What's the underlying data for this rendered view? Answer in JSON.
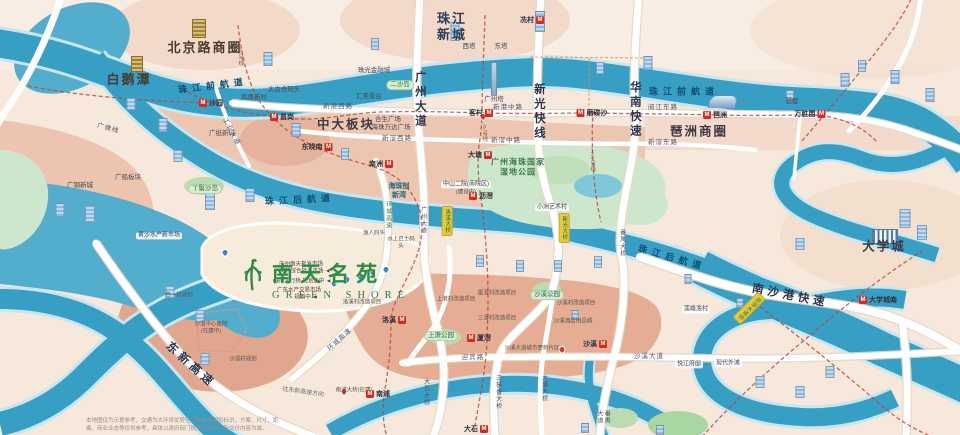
{
  "logo": {
    "cn": "南天名苑",
    "en": "GREEN SHORE"
  },
  "disclaimer": {
    "line1": "本地图仅为示意参考，交通为大环境优势空间距离用图形标识，方案、尺寸、距",
    "line2": "离、商业业态等仅供参考，具体以政府部门批准文件及实际交付内容为准。"
  },
  "colors": {
    "river": "#379fc4",
    "land": "#f6e9db",
    "urban": "#eabda6",
    "salmon": "#e0a287",
    "park": "#cde7cc",
    "road": "#ffffff",
    "metro_line": "#bf4136",
    "metro_icon": "#d42b1e",
    "bridge_tag": "#e9c93c",
    "logo_green": "#2f8a46"
  },
  "labels": [
    {
      "t": "北京路商圈",
      "x": 205,
      "y": 48,
      "c": "a1",
      "n": "area-beijinglu"
    },
    {
      "t": "白鹅潭",
      "x": 129,
      "y": 80,
      "c": "a1",
      "n": "area-baietan"
    },
    {
      "t": "珠江新城",
      "x": 452,
      "y": 27,
      "c": "a2w",
      "w": 34,
      "n": "area-zhujiang-new-town"
    },
    {
      "t": "中大板块",
      "x": 346,
      "y": 125,
      "c": "a2",
      "n": "area-zhongda"
    },
    {
      "t": "琶洲商圈",
      "x": 699,
      "y": 132,
      "c": "a2",
      "n": "area-pazhou"
    },
    {
      "t": "大学城",
      "x": 884,
      "y": 247,
      "c": "a2",
      "n": "area-university-town"
    },
    {
      "t": "广钢新城",
      "x": 80,
      "y": 186,
      "c": "poi",
      "n": "area-guanggang"
    },
    {
      "t": "广船板块",
      "x": 128,
      "y": 178,
      "c": "poi",
      "n": "area-guangchuan"
    },
    {
      "t": "广纸新城",
      "x": 222,
      "y": 134,
      "c": "poi",
      "n": "area-guangzhi"
    },
    {
      "t": "海珠创新湾",
      "x": 399,
      "y": 191,
      "c": "teal",
      "w": 24,
      "n": "area-haizhu-bay"
    },
    {
      "t": "广州海珠国家湿地公园",
      "x": 518,
      "y": 168,
      "c": "green2",
      "w": 60,
      "n": "area-wetland-park"
    },
    {
      "t": "珠江前航道",
      "x": 213,
      "y": 86,
      "c": "rv",
      "r": -7,
      "n": "river-front-channel-west"
    },
    {
      "t": "珠江前航道",
      "x": 684,
      "y": 92,
      "c": "rv",
      "n": "river-front-channel-east"
    },
    {
      "t": "珠江后航道",
      "x": 300,
      "y": 200,
      "c": "rv",
      "r": -3,
      "n": "river-back-channel-west"
    },
    {
      "t": "珠江后航道",
      "x": 672,
      "y": 258,
      "c": "rv",
      "r": 16,
      "n": "river-back-channel-east"
    },
    {
      "t": "广州大道",
      "x": 419,
      "y": 100,
      "c": "rdv",
      "n": "road-guangzhou-avenue"
    },
    {
      "t": "新光快线",
      "x": 538,
      "y": 112,
      "c": "rdv",
      "n": "road-xinguang-express"
    },
    {
      "t": "华南快速",
      "x": 634,
      "y": 110,
      "c": "rdv",
      "n": "road-huanan-expressway"
    },
    {
      "t": "东新高速",
      "x": 190,
      "y": 366,
      "c": "rdr",
      "r": 42,
      "n": "road-dongxin-expressway"
    },
    {
      "t": "南沙港快速",
      "x": 790,
      "y": 297,
      "c": "rdr",
      "r": 11,
      "n": "road-nansha-port-expressway"
    },
    {
      "t": "新港西路",
      "x": 338,
      "y": 107,
      "c": "rdh",
      "n": "road-xingang-west"
    },
    {
      "t": "新港中路",
      "x": 508,
      "y": 108,
      "c": "rdh",
      "n": "road-xingang-middle"
    },
    {
      "t": "阅江东路",
      "x": 663,
      "y": 108,
      "c": "rdh",
      "n": "road-yuejiang-east"
    },
    {
      "t": "新滘西路",
      "x": 397,
      "y": 139,
      "c": "rdh",
      "n": "road-xinjiao-west"
    },
    {
      "t": "新滘中路",
      "x": 506,
      "y": 141,
      "c": "rdh",
      "n": "road-xinjiao-middle"
    },
    {
      "t": "新滘东路",
      "x": 663,
      "y": 143,
      "c": "rdh",
      "n": "road-xinjiao-east"
    },
    {
      "t": "迎宾路",
      "x": 473,
      "y": 358,
      "c": "rdh",
      "n": "road-yingbin"
    },
    {
      "t": "沙溪大道",
      "x": 649,
      "y": 357,
      "c": "rdh",
      "n": "road-shaxi-avenue"
    },
    {
      "t": "工业大道",
      "x": 231,
      "y": 132,
      "c": "rdh",
      "r": 62,
      "n": "road-gongye-avenue"
    },
    {
      "t": "广佛线",
      "x": 108,
      "y": 129,
      "c": "rdh",
      "r": 15,
      "n": "metro-guangfo-line"
    },
    {
      "t": "环城高速",
      "x": 340,
      "y": 340,
      "c": "rdh",
      "r": -42,
      "n": "road-ring-expressway-south"
    },
    {
      "t": "环城高速",
      "x": 387,
      "y": 215,
      "c": "rdgv",
      "n": "road-ring-expressway"
    },
    {
      "t": "广州大道",
      "x": 422,
      "y": 220,
      "c": "rdsv",
      "n": "road-guangzhou-avenue-bridge"
    },
    {
      "t": "番禺大道",
      "x": 602,
      "y": 417,
      "c": "rdsv",
      "n": "road-panyu-avenue"
    },
    {
      "t": "大石大桥",
      "x": 425,
      "y": 392,
      "c": "rdsv",
      "n": "bridge-dashi"
    },
    {
      "t": "三枝香大桥",
      "x": 497,
      "y": 392,
      "c": "rdsv",
      "n": "bridge-sanzhixiang"
    },
    {
      "t": "大涌大桥",
      "x": 543,
      "y": 388,
      "c": "rdsv",
      "n": "bridge-dachong"
    },
    {
      "t": "番禺大桥",
      "x": 621,
      "y": 243,
      "c": "rdsv",
      "n": "bridge-panyu"
    },
    {
      "t": "往东新高速方向",
      "x": 303,
      "y": 393,
      "c": "rdh6",
      "r": 8,
      "n": "road-direction-dongxin"
    },
    {
      "t": "洛溪大桥",
      "x": 447,
      "y": 221,
      "c": "yb",
      "n": "bridge-luoxi-tag"
    },
    {
      "t": "新光大桥",
      "x": 564,
      "y": 228,
      "c": "yb",
      "n": "bridge-xinguang-tag"
    },
    {
      "t": "沥滘水道桥",
      "x": 749,
      "y": 308,
      "c": "yb",
      "r": 45,
      "n": "bridge-lijiao-tag"
    },
    {
      "t": "2号线",
      "x": 240,
      "y": 57,
      "c": "ln",
      "n": "metro-line-2-label"
    },
    {
      "t": "3号线",
      "x": 484,
      "y": 133,
      "c": "ln",
      "n": "metro-line-3-label"
    },
    {
      "t": "12号线",
      "x": 592,
      "y": 160,
      "c": "ln",
      "n": "metro-line-12-label"
    },
    {
      "t": "珠光金融城",
      "x": 374,
      "y": 71,
      "c": "poi",
      "n": "poi-zhuguang-finance"
    },
    {
      "t": "汇美景台",
      "x": 369,
      "y": 97,
      "c": "poi",
      "n": "poi-huimei"
    },
    {
      "t": "太古仓码头",
      "x": 284,
      "y": 90,
      "c": "poi",
      "n": "poi-taikoo-wharf"
    },
    {
      "t": "凤凰新村",
      "x": 254,
      "y": 98,
      "c": "poi",
      "n": "poi-fenghuang"
    },
    {
      "t": "合生广场",
      "x": 388,
      "y": 120,
      "c": "poi",
      "n": "poi-hesheng-plaza"
    },
    {
      "t": "海珠万达广场",
      "x": 391,
      "y": 128,
      "c": "poi",
      "n": "poi-wanda-plaza"
    },
    {
      "t": "中山二院(南院区)",
      "x": 466,
      "y": 185,
      "c": "poiw",
      "n": "poi-hospital-zhongshan"
    },
    {
      "t": "(建设中)",
      "x": 466,
      "y": 193,
      "c": "poi6",
      "n": "poi-hospital-status"
    },
    {
      "t": "西塔",
      "x": 469,
      "y": 47,
      "c": "poi",
      "n": "poi-west-tower"
    },
    {
      "t": "东塔",
      "x": 501,
      "y": 47,
      "c": "poi",
      "n": "poi-east-tower"
    },
    {
      "t": "广州塔",
      "x": 494,
      "y": 100,
      "c": "poi",
      "n": "poi-canton-tower"
    },
    {
      "t": "琶醍",
      "x": 792,
      "y": 102,
      "c": "poi",
      "n": "poi-party-pier"
    },
    {
      "t": "二沙岛",
      "x": 400,
      "y": 85,
      "c": "gp",
      "n": "poi-ersha-island"
    },
    {
      "t": "丫髻沙岛",
      "x": 205,
      "y": 189,
      "c": "gp",
      "n": "poi-yajisha-island"
    },
    {
      "t": "上漖公园",
      "x": 441,
      "y": 336,
      "c": "gp",
      "n": "poi-shangjiao-park"
    },
    {
      "t": "沙溪公园",
      "x": 547,
      "y": 295,
      "c": "gp",
      "n": "poi-shaxi-park"
    },
    {
      "t": "黄沙水产新市场",
      "x": 159,
      "y": 236,
      "c": "poiw",
      "w": 42,
      "n": "poi-huangsha-market"
    },
    {
      "t": "渔人码头",
      "x": 374,
      "y": 234,
      "c": "poi6",
      "n": "poi-fisherman-wharf"
    },
    {
      "t": "水上巴士码头",
      "x": 401,
      "y": 243,
      "c": "poi6",
      "w": 28,
      "n": "poi-water-bus-wharf"
    },
    {
      "t": "洛溪村改造项目",
      "x": 362,
      "y": 303,
      "c": "poi6",
      "n": "poi-luoxi-renewal"
    },
    {
      "t": "上漖村改造项目",
      "x": 456,
      "y": 300,
      "c": "poi6",
      "n": "poi-shangjiao-renewal"
    },
    {
      "t": "厦滘村改造项目",
      "x": 497,
      "y": 294,
      "c": "poi6",
      "n": "poi-xiajiao-renewal"
    },
    {
      "t": "三滘村改造项目",
      "x": 497,
      "y": 319,
      "c": "poi6",
      "n": "poi-sanjiao-renewal"
    },
    {
      "t": "沙溪村改造项目",
      "x": 576,
      "y": 304,
      "c": "poi6",
      "n": "poi-shaxi-renewal"
    },
    {
      "t": "沙溪酒店用品城",
      "x": 573,
      "y": 322,
      "c": "poi6",
      "n": "poi-shaxi-hotel-city"
    },
    {
      "t": "沙溪大道城市更新片区",
      "x": 532,
      "y": 349,
      "c": "poi6",
      "n": "poi-shaxi-renewal-zone"
    },
    {
      "t": "小洲艺术村",
      "x": 552,
      "y": 208,
      "c": "poiw",
      "n": "poi-xiaozhou-village"
    },
    {
      "t": "莲峰渔村",
      "x": 696,
      "y": 310,
      "c": "poiw",
      "n": "poi-lianfeng-village"
    },
    {
      "t": "悦江府邸",
      "x": 689,
      "y": 365,
      "c": "poiw",
      "n": "poi-yuejiang-estate"
    },
    {
      "t": "现代外滩",
      "x": 728,
      "y": 364,
      "c": "poiw",
      "n": "poi-modern-bund"
    },
    {
      "t": "西一村规划",
      "x": 179,
      "y": 296,
      "c": "poi6",
      "n": "poi-xiyi-plan"
    },
    {
      "t": "沙滘村规划",
      "x": 243,
      "y": 360,
      "c": "poi6",
      "n": "poi-shajiao-plan"
    },
    {
      "t": "沙滘中心医院",
      "x": 211,
      "y": 325,
      "c": "poi6",
      "n": "poi-shajiao-hospital"
    },
    {
      "t": "(在建中)",
      "x": 211,
      "y": 332,
      "c": "poi6",
      "n": "poi-shajiao-hospital-status"
    },
    {
      "t": "南浦大桥(在建)",
      "x": 354,
      "y": 391,
      "c": "poi6",
      "n": "poi-nanpu-bridge"
    },
    {
      "t": "广州南天批发市场",
      "x": 301,
      "y": 265,
      "c": "co",
      "n": "callout-nantian-market"
    },
    {
      "t": "海鲜综合批发市场 ◄",
      "x": 305,
      "y": 272,
      "c": "co",
      "n": "callout-seafood-market"
    },
    {
      "t": "CBD人行桥 规划之中 ◄",
      "x": 302,
      "y": 282,
      "c": "co",
      "n": "callout-cbd-footbridge"
    },
    {
      "t": "广东水产交易市场",
      "x": 299,
      "y": 291,
      "c": "co",
      "n": "callout-aquatic-market"
    },
    {
      "t": "规划中 ◄",
      "x": 306,
      "y": 298,
      "c": "co",
      "n": "callout-aquatic-market-status"
    }
  ],
  "stations": [
    {
      "t": "沙园",
      "x": 211,
      "y": 103,
      "s": "r"
    },
    {
      "t": "昌岗",
      "x": 282,
      "y": 117,
      "s": "r"
    },
    {
      "t": "东晓南",
      "x": 317,
      "y": 147,
      "s": "l"
    },
    {
      "t": "冼村",
      "x": 532,
      "y": 20,
      "s": "l"
    },
    {
      "t": "客村",
      "x": 481,
      "y": 113,
      "s": "l"
    },
    {
      "t": "磨碟沙",
      "x": 592,
      "y": 113,
      "s": "r"
    },
    {
      "t": "大塘",
      "x": 480,
      "y": 155,
      "s": "l"
    },
    {
      "t": "沥滘",
      "x": 481,
      "y": 196,
      "s": "r"
    },
    {
      "t": "南洲",
      "x": 381,
      "y": 164,
      "s": "l"
    },
    {
      "t": "琶洲",
      "x": 715,
      "y": 115,
      "s": "r"
    },
    {
      "t": "万胜围",
      "x": 810,
      "y": 114,
      "s": "l"
    },
    {
      "t": "洛溪",
      "x": 394,
      "y": 320,
      "s": "l"
    },
    {
      "t": "厦滘",
      "x": 479,
      "y": 338,
      "s": "r"
    },
    {
      "t": "沙溪",
      "x": 595,
      "y": 344,
      "s": "l"
    },
    {
      "t": "南浦",
      "x": 378,
      "y": 394,
      "s": "r"
    },
    {
      "t": "大石",
      "x": 476,
      "y": 429,
      "s": "l"
    },
    {
      "t": "大学城南",
      "x": 878,
      "y": 300,
      "s": "r"
    }
  ],
  "buildings": [
    {
      "x": 199,
      "y": 38,
      "w": 12,
      "h": 17,
      "k": "g"
    },
    {
      "x": 137,
      "y": 72,
      "w": 10,
      "h": 14,
      "k": "g"
    },
    {
      "x": 494,
      "y": 96,
      "w": 4,
      "h": 32,
      "k": "t"
    },
    {
      "x": 723,
      "y": 108,
      "w": 26,
      "h": 11,
      "k": "e"
    },
    {
      "x": 885,
      "y": 244,
      "w": 24,
      "h": 13,
      "k": "s"
    },
    {
      "x": 268,
      "y": 66,
      "w": 7,
      "h": 12,
      "k": "b"
    },
    {
      "x": 131,
      "y": 110,
      "w": 7,
      "h": 10,
      "k": "b"
    },
    {
      "x": 163,
      "y": 132,
      "w": 7,
      "h": 12,
      "k": "b"
    },
    {
      "x": 296,
      "y": 137,
      "w": 7,
      "h": 12,
      "k": "b"
    },
    {
      "x": 210,
      "y": 210,
      "w": 8,
      "h": 15,
      "k": "b"
    },
    {
      "x": 250,
      "y": 202,
      "w": 7,
      "h": 12,
      "k": "b"
    },
    {
      "x": 178,
      "y": 162,
      "w": 7,
      "h": 10,
      "k": "b"
    },
    {
      "x": 455,
      "y": 41,
      "w": 7,
      "h": 17,
      "k": "b"
    },
    {
      "x": 540,
      "y": 32,
      "w": 8,
      "h": 19,
      "k": "b"
    },
    {
      "x": 600,
      "y": 74,
      "w": 6,
      "h": 10,
      "k": "b"
    },
    {
      "x": 648,
      "y": 70,
      "w": 7,
      "h": 12,
      "k": "b"
    },
    {
      "x": 790,
      "y": 100,
      "w": 6,
      "h": 8,
      "k": "b"
    },
    {
      "x": 845,
      "y": 87,
      "w": 7,
      "h": 12,
      "k": "b"
    },
    {
      "x": 862,
      "y": 72,
      "w": 6,
      "h": 10,
      "k": "b"
    },
    {
      "x": 895,
      "y": 84,
      "w": 7,
      "h": 12,
      "k": "b"
    },
    {
      "x": 905,
      "y": 228,
      "w": 9,
      "h": 17,
      "k": "b"
    },
    {
      "x": 922,
      "y": 240,
      "w": 8,
      "h": 13,
      "k": "b"
    },
    {
      "x": 800,
      "y": 250,
      "w": 7,
      "h": 10,
      "k": "b"
    },
    {
      "x": 480,
      "y": 267,
      "w": 6,
      "h": 10,
      "k": "b"
    },
    {
      "x": 520,
      "y": 272,
      "w": 6,
      "h": 10,
      "k": "b"
    },
    {
      "x": 558,
      "y": 272,
      "w": 6,
      "h": 10,
      "k": "b"
    },
    {
      "x": 598,
      "y": 268,
      "w": 6,
      "h": 10,
      "k": "b"
    },
    {
      "x": 688,
      "y": 284,
      "w": 5,
      "h": 8,
      "k": "b"
    },
    {
      "x": 740,
      "y": 308,
      "w": 5,
      "h": 8,
      "k": "b"
    },
    {
      "x": 170,
      "y": 298,
      "w": 7,
      "h": 10,
      "k": "b"
    },
    {
      "x": 200,
      "y": 322,
      "w": 7,
      "h": 10,
      "k": "b"
    },
    {
      "x": 575,
      "y": 320,
      "w": 5,
      "h": 8,
      "k": "b"
    },
    {
      "x": 760,
      "y": 388,
      "w": 7,
      "h": 10,
      "k": "b"
    },
    {
      "x": 800,
      "y": 398,
      "w": 7,
      "h": 10,
      "k": "b"
    },
    {
      "x": 830,
      "y": 378,
      "w": 7,
      "h": 10,
      "k": "b"
    },
    {
      "x": 60,
      "y": 217,
      "w": 7,
      "h": 12,
      "k": "b"
    },
    {
      "x": 90,
      "y": 222,
      "w": 8,
      "h": 14,
      "k": "b"
    },
    {
      "x": 345,
      "y": 160,
      "w": 6,
      "h": 10,
      "k": "b"
    },
    {
      "x": 375,
      "y": 50,
      "w": 6,
      "h": 10,
      "k": "b"
    },
    {
      "x": 930,
      "y": 102,
      "w": 7,
      "h": 12,
      "k": "b"
    },
    {
      "x": 205,
      "y": 365,
      "w": 7,
      "h": 10,
      "k": "b"
    },
    {
      "x": 660,
      "y": 435,
      "w": 6,
      "h": 8,
      "k": "b"
    },
    {
      "x": 585,
      "y": 433,
      "w": 6,
      "h": 8,
      "k": "b"
    }
  ],
  "pins_blue": [
    [
      334,
      287
    ],
    [
      347,
      283
    ],
    [
      360,
      280
    ],
    [
      373,
      276
    ],
    [
      386,
      273
    ],
    [
      225,
      256
    ]
  ],
  "pins_red": [
    [
      562,
      353
    ],
    [
      344,
      395
    ],
    [
      483,
      120
    ]
  ]
}
